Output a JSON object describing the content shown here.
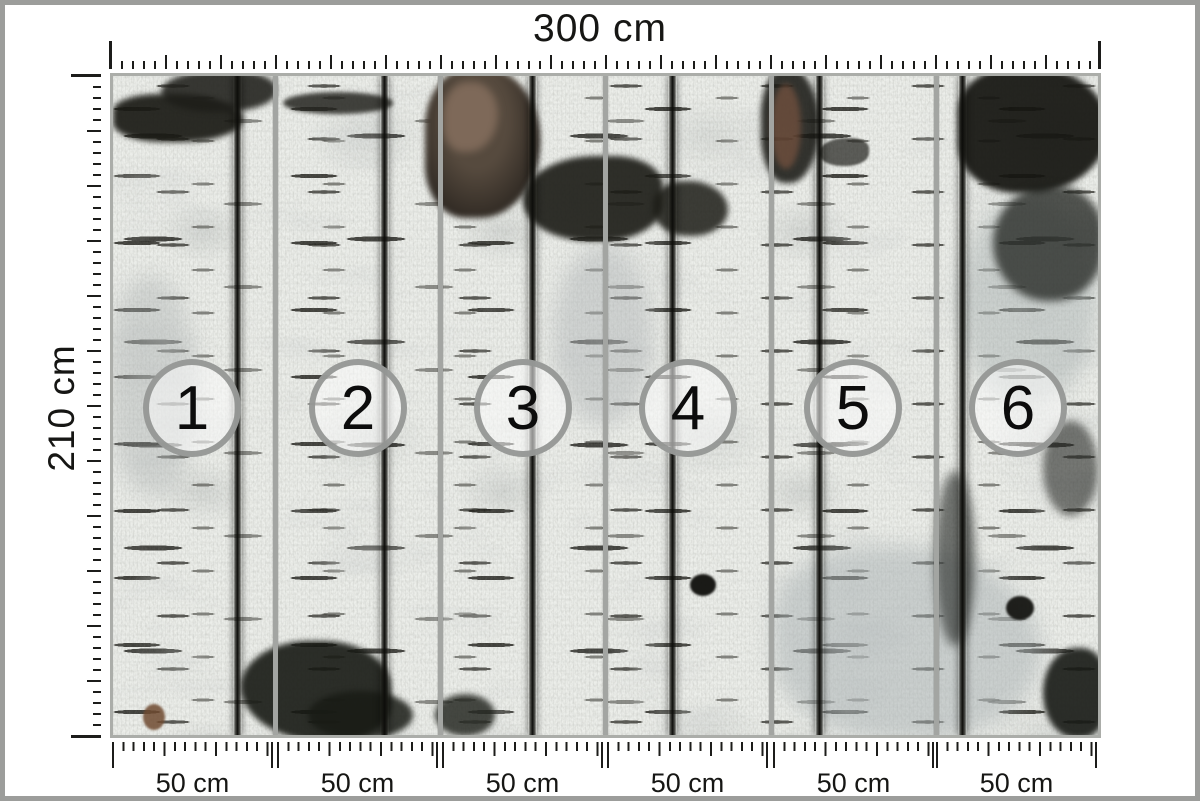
{
  "product": {
    "total_width_label": "300 cm",
    "total_height_label": "210 cm",
    "panel_count": 6,
    "description": "birch bark photo wallpaper divided into 6 numbered panels"
  },
  "panels": [
    {
      "number": "1",
      "width_label": "50 cm"
    },
    {
      "number": "2",
      "width_label": "50 cm"
    },
    {
      "number": "3",
      "width_label": "50 cm"
    },
    {
      "number": "4",
      "width_label": "50 cm"
    },
    {
      "number": "5",
      "width_label": "50 cm"
    },
    {
      "number": "6",
      "width_label": "50 cm"
    }
  ],
  "colors": {
    "frame_gray": "#9c9d9b",
    "tick_black": "#1c1c1a",
    "separator_gray": "#a3a5a2",
    "circle_ring_gray": "#949694",
    "bark_base": "#eceeea"
  }
}
